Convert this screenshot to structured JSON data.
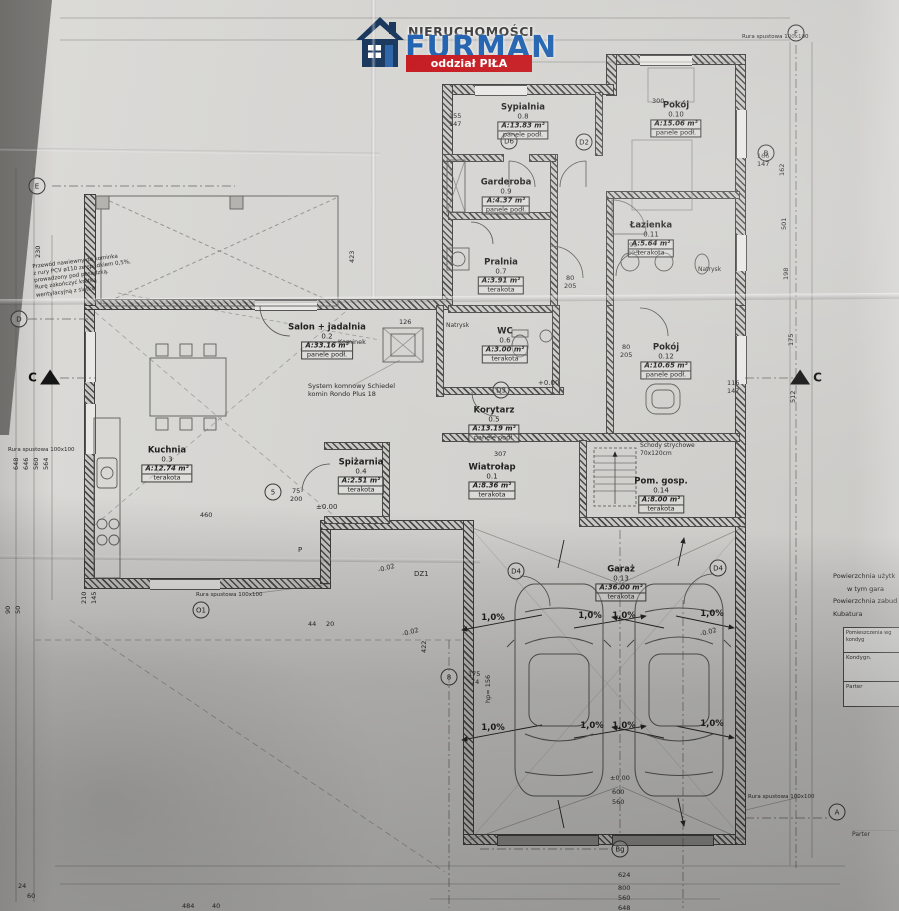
{
  "logo": {
    "line1": "NIERUCHOMOŚCI",
    "line2": "FURMAN",
    "banner": "oddział PIŁA",
    "brand_blue": "#1d5fae",
    "banner_red": "#c4161c",
    "house_navy": "#17355c"
  },
  "slope_text": "1,0%",
  "rooms": [
    {
      "name": "Sypialnia",
      "number": "0.8",
      "area": "A:13.83 m²",
      "floor": "panele podł.",
      "x": 523,
      "y": 122
    },
    {
      "name": "Pokój",
      "number": "0.10",
      "area": "A:15.06 m²",
      "floor": "panele podł.",
      "x": 676,
      "y": 120
    },
    {
      "name": "Garderoba",
      "number": "0.9",
      "area": "A:4.37 m²",
      "floor": "panele podł.",
      "x": 506,
      "y": 197
    },
    {
      "name": "Łazienka",
      "number": "0.11",
      "area": "A:5.64 m²",
      "floor": "terakota",
      "x": 651,
      "y": 240
    },
    {
      "name": "Pralnia",
      "number": "0.7",
      "area": "A:3.91 m²",
      "floor": "terakota",
      "x": 501,
      "y": 277
    },
    {
      "name": "Salon + jadalnia",
      "number": "0.2",
      "area": "A:33.16 m²",
      "floor": "panele podł.",
      "x": 327,
      "y": 342
    },
    {
      "name": "WC",
      "number": "0.6",
      "area": "A:3.00 m²",
      "floor": "terakota",
      "x": 505,
      "y": 346
    },
    {
      "name": "Pokój",
      "number": "0.12",
      "area": "A:10.65 m²",
      "floor": "panele podł.",
      "x": 666,
      "y": 362
    },
    {
      "name": "Korytarz",
      "number": "0.5",
      "area": "A:13.19 m²",
      "floor": "panele podł.",
      "x": 494,
      "y": 425
    },
    {
      "name": "Kuchnia",
      "number": "0.3",
      "area": "A:12.74 m²",
      "floor": "terakota",
      "x": 167,
      "y": 465
    },
    {
      "name": "Spiżarnia",
      "number": "0.4",
      "area": "A:2.51 m²",
      "floor": "terakota",
      "x": 361,
      "y": 477
    },
    {
      "name": "Wiatrołap",
      "number": "0.1",
      "area": "A:8.36 m²",
      "floor": "terakota",
      "x": 492,
      "y": 482
    },
    {
      "name": "Pom. gosp.",
      "number": "0.14",
      "area": "A:8.00 m²",
      "floor": "terakota",
      "x": 661,
      "y": 496
    },
    {
      "name": "Garaż",
      "number": "0.13",
      "area": "A:36.00 m²",
      "floor": "terakota",
      "x": 621,
      "y": 584
    }
  ],
  "dims": [
    {
      "t": "155",
      "x": 449,
      "y": 112,
      "r": 0
    },
    {
      "t": "147",
      "x": 449,
      "y": 120,
      "r": 0
    },
    {
      "t": "300",
      "x": 652,
      "y": 97,
      "r": 0
    },
    {
      "t": "166",
      "x": 757,
      "y": 152,
      "r": 0
    },
    {
      "t": "147",
      "x": 757,
      "y": 160,
      "r": 0
    },
    {
      "t": "116",
      "x": 727,
      "y": 379,
      "r": 0
    },
    {
      "t": "147",
      "x": 727,
      "y": 387,
      "r": 0
    },
    {
      "t": "80",
      "x": 566,
      "y": 274,
      "r": 0
    },
    {
      "t": "205",
      "x": 564,
      "y": 282,
      "r": 0
    },
    {
      "t": "90",
      "x": 629,
      "y": 241,
      "r": 0
    },
    {
      "t": "205",
      "x": 627,
      "y": 249,
      "r": 0
    },
    {
      "t": "80",
      "x": 622,
      "y": 343,
      "r": 0
    },
    {
      "t": "205",
      "x": 620,
      "y": 351,
      "r": 0
    },
    {
      "t": "75",
      "x": 292,
      "y": 487,
      "r": 0
    },
    {
      "t": "200",
      "x": 290,
      "y": 495,
      "r": 0
    },
    {
      "t": "126",
      "x": 399,
      "y": 318,
      "r": 0
    },
    {
      "t": "307",
      "x": 494,
      "y": 450,
      "r": 0
    },
    {
      "t": "230",
      "x": 42,
      "y": 250,
      "r": -90
    },
    {
      "t": "648",
      "x": 20,
      "y": 462,
      "r": -90
    },
    {
      "t": "646",
      "x": 30,
      "y": 462,
      "r": -90
    },
    {
      "t": "560",
      "x": 40,
      "y": 462,
      "r": -90
    },
    {
      "t": "564",
      "x": 50,
      "y": 462,
      "r": -90
    },
    {
      "t": "423",
      "x": 356,
      "y": 255,
      "r": -90
    },
    {
      "t": "210",
      "x": 88,
      "y": 596,
      "r": -90
    },
    {
      "t": "145",
      "x": 98,
      "y": 596,
      "r": -90
    },
    {
      "t": "90",
      "x": 12,
      "y": 606,
      "r": -90
    },
    {
      "t": "50",
      "x": 22,
      "y": 606,
      "r": -90
    },
    {
      "t": "44",
      "x": 308,
      "y": 620,
      "r": 0
    },
    {
      "t": "20",
      "x": 326,
      "y": 620,
      "r": 0
    },
    {
      "t": "175",
      "x": 468,
      "y": 670,
      "r": 0
    },
    {
      "t": "74",
      "x": 471,
      "y": 678,
      "r": 0
    },
    {
      "t": "hp= 156",
      "x": 492,
      "y": 695,
      "r": -90
    },
    {
      "t": "422",
      "x": 428,
      "y": 645,
      "r": -90
    },
    {
      "t": "600",
      "x": 612,
      "y": 788,
      "r": 0
    },
    {
      "t": "560",
      "x": 612,
      "y": 798,
      "r": 0
    },
    {
      "t": "624",
      "x": 618,
      "y": 871,
      "r": 0
    },
    {
      "t": "800",
      "x": 618,
      "y": 884,
      "r": 0
    },
    {
      "t": "560",
      "x": 618,
      "y": 894,
      "r": 0
    },
    {
      "t": "648",
      "x": 618,
      "y": 904,
      "r": 0
    },
    {
      "t": "484",
      "x": 182,
      "y": 902,
      "r": 0
    },
    {
      "t": "40",
      "x": 212,
      "y": 902,
      "r": 0
    },
    {
      "t": "24",
      "x": 18,
      "y": 882,
      "r": 0
    },
    {
      "t": "60",
      "x": 27,
      "y": 892,
      "r": 0
    },
    {
      "t": "162",
      "x": 786,
      "y": 168,
      "r": -90
    },
    {
      "t": "501",
      "x": 788,
      "y": 222,
      "r": -90
    },
    {
      "t": "198",
      "x": 790,
      "y": 272,
      "r": -90
    },
    {
      "t": "175",
      "x": 795,
      "y": 338,
      "r": -90
    },
    {
      "t": "512",
      "x": 797,
      "y": 395,
      "r": -90
    },
    {
      "t": "460",
      "x": 200,
      "y": 511,
      "r": 0
    }
  ],
  "annotations": [
    {
      "t": "Przewód nawiewny do kominka\nz rury PCV ø110 ze spadkiem 0,5%,\nprowadzony pod posadzką.\nRurę zakończyć kratką\nwentylacyjną z siatką",
      "x": 34,
      "y": 258,
      "fs": 5.5,
      "r": -7
    },
    {
      "t": "Kominek",
      "x": 338,
      "y": 338,
      "fs": 6.5,
      "r": 0
    },
    {
      "t": "System komnowy Schiedel\nkomin Rondo Plus 18",
      "x": 308,
      "y": 382,
      "fs": 6.5,
      "r": 0
    },
    {
      "t": "Natrysk",
      "x": 446,
      "y": 322,
      "fs": 6,
      "r": 0
    },
    {
      "t": "Natrysk",
      "x": 698,
      "y": 266,
      "fs": 6,
      "r": 0
    },
    {
      "t": "Schody strychowe\n70x120cm",
      "x": 640,
      "y": 442,
      "fs": 6,
      "r": 0
    },
    {
      "t": "Rura spustowa 100x100",
      "x": 8,
      "y": 447,
      "fs": 5.5,
      "r": 0
    },
    {
      "t": "Rura spustowa 100x100",
      "x": 196,
      "y": 592,
      "fs": 5.5,
      "r": 0
    },
    {
      "t": "Rura spustowa 100x100",
      "x": 748,
      "y": 794,
      "fs": 5.5,
      "r": 0
    },
    {
      "t": "Rura spustowa 100x100",
      "x": 742,
      "y": 34,
      "fs": 5.5,
      "r": 0
    },
    {
      "t": "±0.00",
      "x": 316,
      "y": 503,
      "fs": 7,
      "r": 0
    },
    {
      "t": "+0.00",
      "x": 538,
      "y": 379,
      "fs": 7,
      "r": 0
    },
    {
      "t": "±0.00",
      "x": 610,
      "y": 774,
      "fs": 6.5,
      "r": 0
    },
    {
      "t": "-0.02",
      "x": 378,
      "y": 564,
      "fs": 6.5,
      "r": -15
    },
    {
      "t": "-0.02",
      "x": 402,
      "y": 628,
      "fs": 6.5,
      "r": -15
    },
    {
      "t": "-0.02",
      "x": 700,
      "y": 628,
      "fs": 6.5,
      "r": -15
    },
    {
      "t": "DZ1",
      "x": 414,
      "y": 570,
      "fs": 7,
      "r": 0
    },
    {
      "t": "P",
      "x": 298,
      "y": 546,
      "fs": 7,
      "r": 0
    }
  ],
  "markers": [
    {
      "l": "E",
      "x": 37,
      "y": 186,
      "s": "circle"
    },
    {
      "l": "D",
      "x": 19,
      "y": 319,
      "s": "circle"
    },
    {
      "l": "F",
      "x": 796,
      "y": 33,
      "s": "circle"
    },
    {
      "l": "B",
      "x": 766,
      "y": 153,
      "s": "circle"
    },
    {
      "l": "A",
      "x": 837,
      "y": 812,
      "s": "circle"
    },
    {
      "l": "Bg",
      "x": 620,
      "y": 849,
      "s": "circle"
    },
    {
      "l": "O1",
      "x": 201,
      "y": 610,
      "s": "circle"
    },
    {
      "l": "8",
      "x": 449,
      "y": 677,
      "s": "circle"
    },
    {
      "l": "D6",
      "x": 509,
      "y": 141,
      "s": "circle"
    },
    {
      "l": "D2",
      "x": 584,
      "y": 142,
      "s": "circle"
    },
    {
      "l": "D3",
      "x": 501,
      "y": 390,
      "s": "circle"
    },
    {
      "l": "D4",
      "x": 516,
      "y": 571,
      "s": "circle"
    },
    {
      "l": "D4",
      "x": 718,
      "y": 568,
      "s": "circle"
    },
    {
      "l": "5",
      "x": 273,
      "y": 492,
      "s": "circle"
    },
    {
      "l": "C",
      "x": 44,
      "y": 377,
      "s": "tri-left"
    },
    {
      "l": "C",
      "x": 806,
      "y": 377,
      "s": "tri-right"
    }
  ],
  "slopes": [
    {
      "x": 493,
      "y": 618
    },
    {
      "x": 590,
      "y": 616
    },
    {
      "x": 624,
      "y": 616
    },
    {
      "x": 712,
      "y": 614
    },
    {
      "x": 493,
      "y": 728
    },
    {
      "x": 592,
      "y": 726
    },
    {
      "x": 624,
      "y": 726
    },
    {
      "x": 712,
      "y": 724
    }
  ],
  "summary": {
    "lines": [
      "Powierzchnia użytk",
      "w tym gara",
      "Powierzchnia zabud",
      "Kubatura"
    ]
  },
  "table": {
    "header": "Pomieszczenia wg kondyg",
    "col": "Kondygn.",
    "row": "Parter",
    "row2": "Parter"
  }
}
